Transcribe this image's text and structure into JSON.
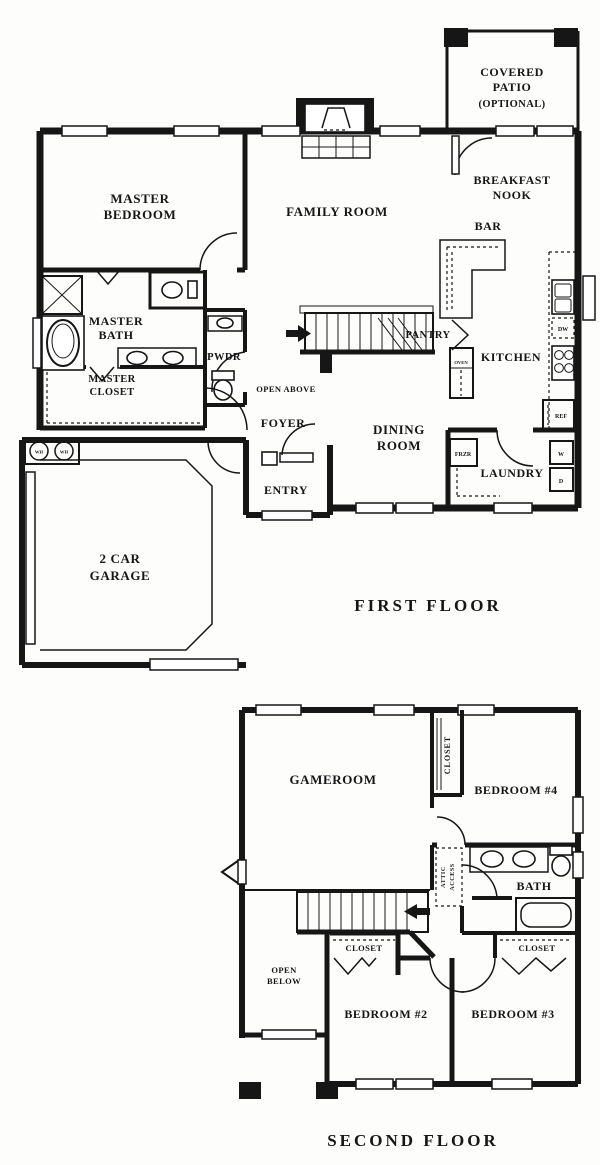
{
  "page": {
    "background": "#fdfdfc",
    "ink": "#161616"
  },
  "first_floor": {
    "caption": "FIRST FLOOR",
    "labels": {
      "covered_patio_1": "COVERED",
      "covered_patio_2": "PATIO",
      "covered_patio_3": "(OPTIONAL)",
      "master_bedroom_1": "MASTER",
      "master_bedroom_2": "BEDROOM",
      "family_room": "FAMILY ROOM",
      "breakfast_nook_1": "BREAKFAST",
      "breakfast_nook_2": "NOOK",
      "bar": "BAR",
      "master_bath_1": "MASTER",
      "master_bath_2": "BATH",
      "pwdr": "PWDR",
      "pantry": "PANTRY",
      "kitchen": "KITCHEN",
      "oven": "OVEN",
      "dw": "DW",
      "ref": "REF",
      "frzr": "FRZR",
      "washer": "W",
      "dryer": "D",
      "wh": "WH",
      "master_closet_1": "MASTER",
      "master_closet_2": "CLOSET",
      "open_above": "OPEN ABOVE",
      "foyer": "FOYER",
      "dining_room_1": "DINING",
      "dining_room_2": "ROOM",
      "entry": "ENTRY",
      "laundry": "LAUNDRY",
      "garage_1": "2 CAR",
      "garage_2": "GARAGE"
    }
  },
  "second_floor": {
    "caption": "SECOND FLOOR",
    "labels": {
      "gameroom": "GAMEROOM",
      "bedroom4": "BEDROOM #4",
      "closet_b4": "CLOSET",
      "attic_access_1": "ATTIC",
      "attic_access_2": "ACCESS",
      "bath": "BATH",
      "closet_b2": "CLOSET",
      "closet_b3": "CLOSET",
      "open_below_1": "OPEN",
      "open_below_2": "BELOW",
      "bedroom2": "BEDROOM #2",
      "bedroom3": "BEDROOM #3"
    }
  }
}
